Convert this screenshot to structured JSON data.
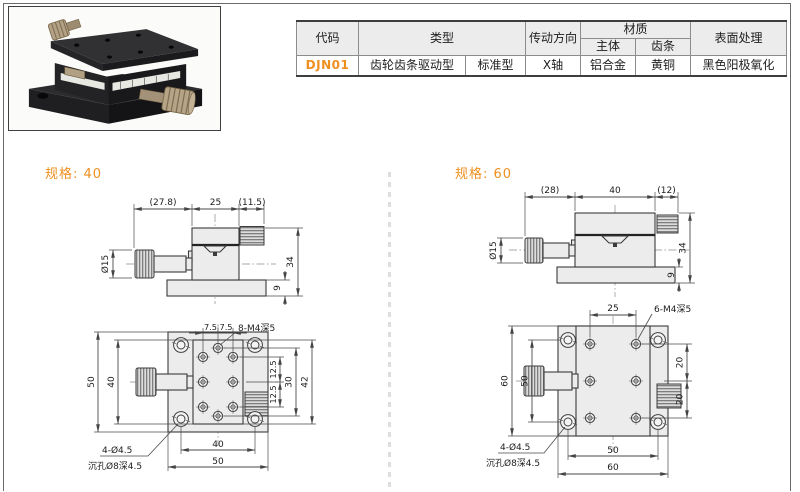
{
  "page": {
    "accent_color": "#ef8f1f",
    "drawing_line_color": "#3b3b3b"
  },
  "table": {
    "headers": {
      "code": "代码",
      "type": "类型",
      "direction": "传动方向",
      "material": "材质",
      "material_body": "主体",
      "material_rack": "齿条",
      "surface": "表面处理"
    },
    "row": {
      "code": "DJN01",
      "type_main": "齿轮齿条驱动型",
      "type_sub": "标准型",
      "direction": "X轴",
      "material_body": "铝合金",
      "material_rack": "黄铜",
      "surface": "黑色阳极氧化"
    }
  },
  "spec40": {
    "title": "规格: 40",
    "side": {
      "dim_top_left": "(27.8)",
      "dim_top_mid": "25",
      "dim_top_right": "(11.5)",
      "dim_knob_dia": "Ø15",
      "dim_total_height": "34",
      "dim_base_height": "9"
    },
    "plan": {
      "dim_top_a": "7.5",
      "dim_top_b": "7.5",
      "callout_holes": "8-M4深5",
      "dim_left_outer": "50",
      "dim_left_inner": "40",
      "dim_right_a": "12.5",
      "dim_right_b": "12.5",
      "dim_right_mid": "30",
      "dim_right_outer": "42",
      "callout_corner_line1": "4-Ø4.5",
      "callout_corner_line2": "沉孔Ø8深4.5",
      "dim_bottom_inner": "40",
      "dim_bottom_outer": "50"
    }
  },
  "spec60": {
    "title": "规格: 60",
    "side": {
      "dim_top_left": "(28)",
      "dim_top_mid": "40",
      "dim_top_right": "(12)",
      "dim_knob_dia": "Ø15",
      "dim_total_height": "34",
      "dim_base_height": "9"
    },
    "plan": {
      "dim_top": "25",
      "callout_holes": "6-M4深5",
      "dim_left_outer": "60",
      "dim_left_inner": "50",
      "dim_right_a": "20",
      "dim_right_b": "20",
      "callout_corner_line1": "4-Ø4.5",
      "callout_corner_line2": "沉孔Ø8深4.5",
      "dim_bottom_inner": "50",
      "dim_bottom_outer": "60"
    }
  }
}
